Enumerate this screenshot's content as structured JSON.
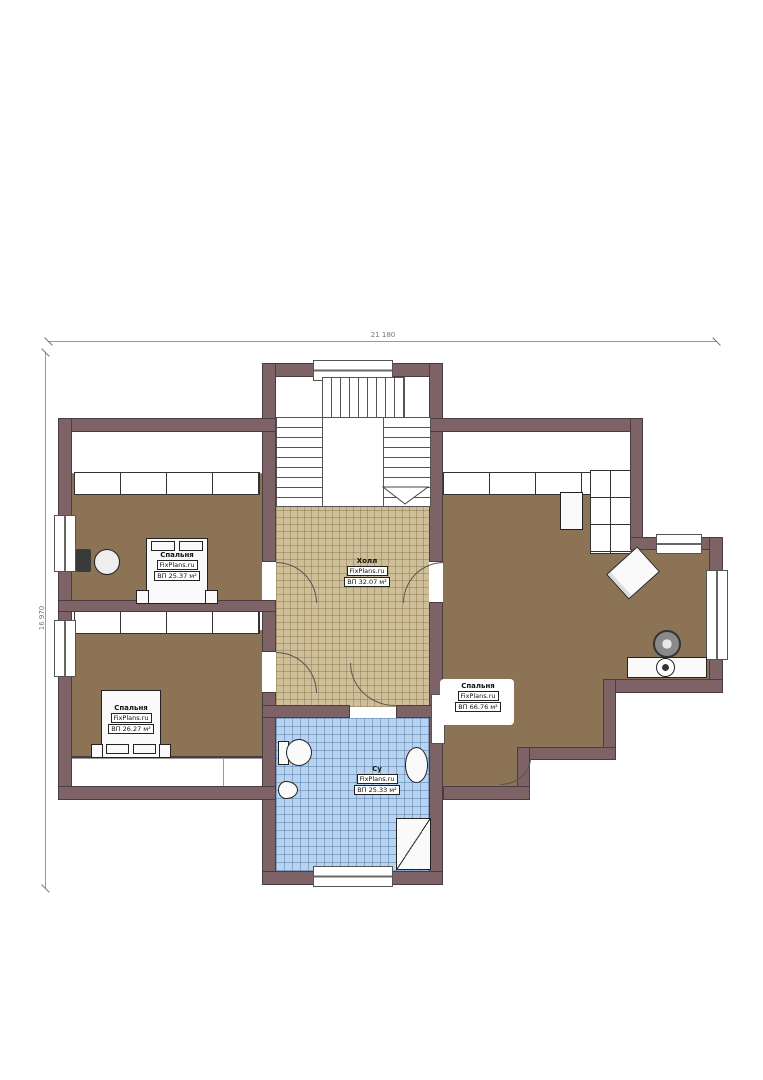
{
  "plan": {
    "type": "floor-plan",
    "dimension_top": "21 180",
    "dimension_left": "16 970",
    "rooms": [
      {
        "id": "bedroom-top-left",
        "name": "Спальня",
        "watermark": "FixPlans.ru",
        "area": "ВП 25.37 м²"
      },
      {
        "id": "bedroom-bottom-left",
        "name": "Спальня",
        "watermark": "FixPlans.ru",
        "area": "ВП 26.27 м²"
      },
      {
        "id": "hall",
        "name": "Холл",
        "watermark": "FixPlans.ru",
        "area": "ВП 32.07 м²"
      },
      {
        "id": "bedroom-right",
        "name": "Спальня",
        "watermark": "FixPlans.ru",
        "area": "ВП 66.76 м²"
      },
      {
        "id": "bathroom",
        "name": "Су",
        "watermark": "FixPlans.ru",
        "area": "ВП 25.33 м²"
      }
    ]
  },
  "colors": {
    "wall": "#7d6266",
    "wall_outline": "#4a3c40",
    "wood_floor": "#8c7355",
    "hall_tile": "#cfbf98",
    "bath_tile": "#b7d3ef",
    "dimension": "#9a9a9a",
    "background": "#ffffff"
  }
}
